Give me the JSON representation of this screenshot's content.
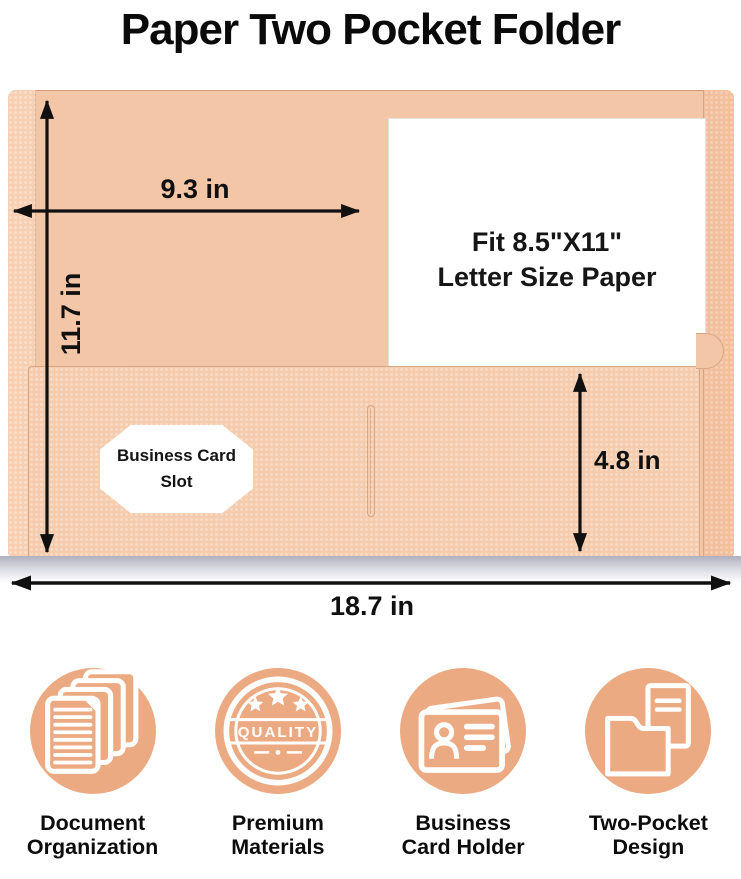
{
  "title": "Paper Two Pocket Folder",
  "diagram": {
    "width_top_label": "9.3 in",
    "height_left_label": "11.7 in",
    "pocket_height_label": "4.8 in",
    "width_bottom_label": "18.7 in",
    "paper_line1": "Fit 8.5\"X11\"",
    "paper_line2": "Letter Size Paper",
    "card_slot_line1": "Business Card",
    "card_slot_line2": "Slot"
  },
  "features": [
    {
      "icon": "stacked-documents-icon",
      "line1": "Document",
      "line2": "Organization"
    },
    {
      "icon": "quality-badge-icon",
      "line1": "Premium",
      "line2": "Materials",
      "badge_text": "QUALITY"
    },
    {
      "icon": "business-card-icon",
      "line1": "Business",
      "line2": "Card Holder"
    },
    {
      "icon": "two-pocket-folder-icon",
      "line1": "Two-Pocket",
      "line2": "Design"
    }
  ],
  "colors": {
    "folder_body": "#f3c6a7",
    "folder_pocket": "#f5ccae",
    "icon_circle": "#ecaa83",
    "text": "#0d0d0d",
    "shadow": "#b0b1bf",
    "arrow": "#101010"
  }
}
